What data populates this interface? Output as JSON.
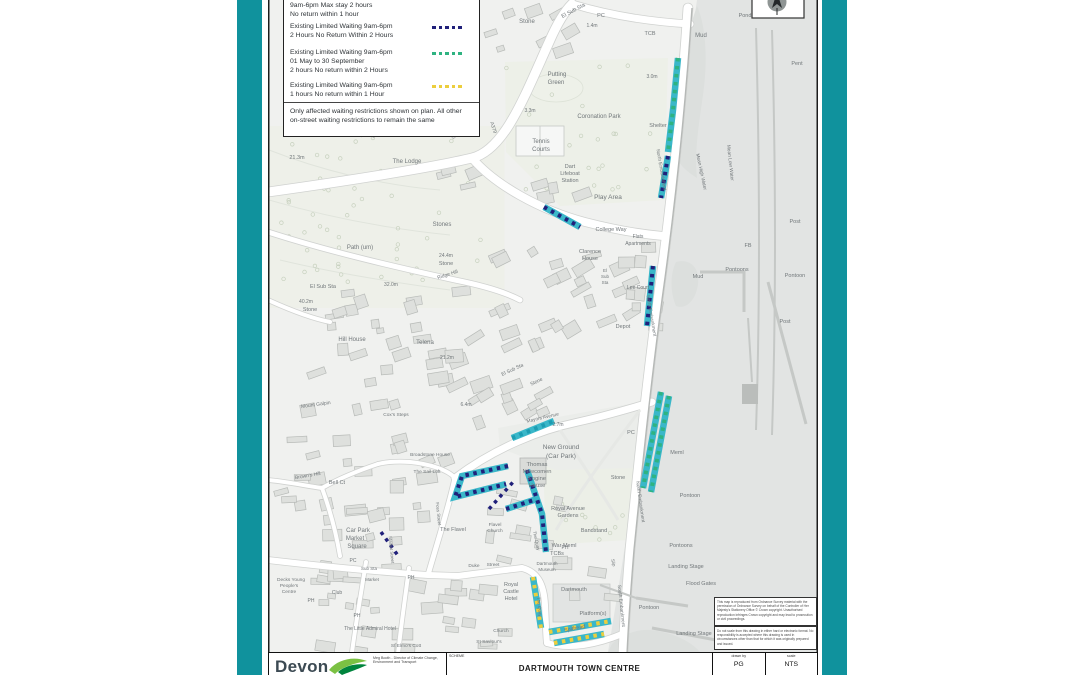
{
  "frame": {
    "teal": "#10929d",
    "sheet_border": "#1c1c1c"
  },
  "legend": {
    "entries": [
      {
        "lines": [
          "9am-6pm Max stay 2 hours",
          "No return within 1 hour"
        ],
        "swatch": null
      },
      {
        "lines": [
          "Existing Limited Waiting 9am-6pm",
          "2 Hours No Return Within 2 Hours"
        ],
        "swatch": "navy"
      },
      {
        "lines": [
          "Existing Limited Waiting 9am-6pm",
          "01 May to 30 September",
          "2 hours No return within 2 Hours"
        ],
        "swatch": "green"
      },
      {
        "lines": [
          "Existing Limited Waiting 9am-6pm",
          "1 hours No return within 1 Hour"
        ],
        "swatch": "yellow"
      }
    ],
    "note_lines": [
      "Only affected waiting restrictions shown on plan. All other",
      "on-street waiting restrictions to remain the same"
    ]
  },
  "title_block": {
    "logo_text": "Devon",
    "org_lines": [
      "Meg Booth - Director of Climate Change,",
      "Environment and Transport"
    ],
    "scheme_label": "SCHEME",
    "scheme": "DARTMOUTH TOWN CENTRE",
    "drawn_by_label": "drawn by",
    "drawn_by": "PG",
    "scale_label": "scale",
    "scale": "NTS"
  },
  "notes": {
    "copyright": "This map is reproduced from Ordnance Survey material with the permission of Ordnance Survey on behalf of the Controller of Her Majesty's Stationery Office © Crown copyright. Unauthorised reproduction infringes Crown copyright and may lead to prosecution or civil proceedings.",
    "disclaimer": "Do not scale from this drawing in either hard or electronic format. No responsibility is accepted where this drawing is used in circumstances other than that for which it was originally prepared and issued."
  },
  "map": {
    "colors": {
      "cyan": "#3ab7c9",
      "cyan-dark": "#1d9db2",
      "navy": "#20207a",
      "green": "#2fb381",
      "yellow": "#ecce3d"
    },
    "restrictions": [
      {
        "road": "North Embankment",
        "base": "cyan",
        "dash": "green",
        "pts": [
          [
            678,
            58
          ],
          [
            673,
            110
          ],
          [
            668,
            152
          ]
        ]
      },
      {
        "road": "North Embankment",
        "base": "cyan",
        "dash": "navy",
        "pts": [
          [
            668,
            156
          ],
          [
            661,
            198
          ]
        ]
      },
      {
        "road": "North Embankment",
        "base": "cyan",
        "dash": "navy",
        "pts": [
          [
            653,
            266
          ],
          [
            647,
            326
          ]
        ]
      },
      {
        "road": "North Embankment",
        "base": "cyan",
        "dash": "green",
        "pts": [
          [
            661,
            392
          ],
          [
            643,
            488
          ]
        ]
      },
      {
        "road": "North Embankment",
        "base": "cyan",
        "dash": "green",
        "pts": [
          [
            669,
            396
          ],
          [
            651,
            492
          ]
        ]
      },
      {
        "road": "College Way",
        "base": "cyan",
        "dash": "navy",
        "pts": [
          [
            544,
            207
          ],
          [
            580,
            227
          ]
        ]
      },
      {
        "road": "Mayors Avenue",
        "base": "cyan",
        "dash": "cyan-dark",
        "pts": [
          [
            512,
            438
          ],
          [
            554,
            421
          ]
        ]
      },
      {
        "road": "The Quay loop",
        "base": "cyan",
        "dash": "navy",
        "pts": [
          [
            508,
            466
          ],
          [
            462,
            476
          ],
          [
            455,
            497
          ],
          [
            506,
            484
          ]
        ]
      },
      {
        "road": "The Quay bar",
        "base": "cyan",
        "dash": "navy",
        "pts": [
          [
            506,
            509
          ],
          [
            534,
            500
          ]
        ]
      },
      {
        "road": "The Quay",
        "base": "cyan",
        "dash": "navy",
        "pts": [
          [
            527,
            470
          ],
          [
            542,
            514
          ],
          [
            546,
            552
          ]
        ]
      },
      {
        "road": "Mayors Avenue lower",
        "base": null,
        "dash": "navy",
        "pts": [
          [
            489,
            509
          ],
          [
            514,
            481
          ]
        ]
      },
      {
        "road": "Lower Street",
        "base": null,
        "dash": "navy",
        "pts": [
          [
            381,
            532
          ],
          [
            399,
            557
          ]
        ]
      },
      {
        "road": "The Quay south",
        "base": "cyan",
        "dash": "yellow",
        "pts": [
          [
            533,
            577
          ],
          [
            541,
            628
          ]
        ]
      },
      {
        "road": "Spithead",
        "base": "cyan",
        "dash": "yellow",
        "pts": [
          [
            549,
            632
          ],
          [
            611,
            621
          ]
        ]
      },
      {
        "road": "Spithead",
        "base": "cyan",
        "dash": "yellow",
        "pts": [
          [
            554,
            643
          ],
          [
            604,
            634
          ]
        ]
      }
    ],
    "labels": [
      {
        "t": "Stone",
        "x": 527,
        "y": 23
      },
      {
        "t": "El Sub Sta",
        "x": 574,
        "y": 12,
        "r": -28,
        "s": 5.5
      },
      {
        "t": "PC",
        "x": 601,
        "y": 17,
        "s": 5.5
      },
      {
        "t": "1.4m",
        "x": 592,
        "y": 27,
        "s": 5
      },
      {
        "t": "TCB",
        "x": 650,
        "y": 35,
        "s": 5.5
      },
      {
        "t": "Mud",
        "x": 701,
        "y": 37
      },
      {
        "t": "Pond",
        "x": 745,
        "y": 17,
        "s": 5.5
      },
      {
        "t": "Pent",
        "x": 797,
        "y": 65,
        "s": 5.5
      },
      {
        "t": "Putting",
        "x": 557,
        "y": 76
      },
      {
        "t": "Green",
        "x": 556,
        "y": 84
      },
      {
        "t": "3.0m",
        "x": 652,
        "y": 78,
        "s": 5
      },
      {
        "t": "3.3m",
        "x": 530,
        "y": 112,
        "s": 5
      },
      {
        "t": "Coronation Park",
        "x": 599,
        "y": 118
      },
      {
        "t": "Shelter",
        "x": 658,
        "y": 127,
        "s": 5.5
      },
      {
        "t": "Tennis",
        "x": 541,
        "y": 143
      },
      {
        "t": "Courts",
        "x": 541,
        "y": 151
      },
      {
        "t": "Dart",
        "x": 570,
        "y": 168,
        "s": 5.5
      },
      {
        "t": "Lifeboat",
        "x": 570,
        "y": 175,
        "s": 5.5
      },
      {
        "t": "Station",
        "x": 570,
        "y": 182,
        "s": 5.5
      },
      {
        "t": "Play Area",
        "x": 608,
        "y": 199,
        "s": 6.5
      },
      {
        "t": "21.3m",
        "x": 297,
        "y": 159,
        "s": 5.5
      },
      {
        "t": "The Lodge",
        "x": 407,
        "y": 163
      },
      {
        "t": "Stones",
        "x": 442,
        "y": 226
      },
      {
        "t": "Path (um)",
        "x": 360,
        "y": 249
      },
      {
        "t": "24.4m",
        "x": 446,
        "y": 257,
        "s": 5
      },
      {
        "t": "Stone",
        "x": 446,
        "y": 265,
        "s": 5.5
      },
      {
        "t": "Ridge Hill",
        "x": 448,
        "y": 276,
        "r": -18,
        "s": 5
      },
      {
        "t": "32.0m",
        "x": 391,
        "y": 286,
        "s": 5
      },
      {
        "t": "El Sub Sta",
        "x": 323,
        "y": 288,
        "s": 5.5
      },
      {
        "t": "40.2m",
        "x": 306,
        "y": 303,
        "s": 5
      },
      {
        "t": "Stone",
        "x": 310,
        "y": 311,
        "s": 5.5
      },
      {
        "t": "A379",
        "x": 492,
        "y": 128,
        "r": 72,
        "s": 5
      },
      {
        "t": "College Way",
        "x": 611,
        "y": 231,
        "s": 5.5
      },
      {
        "t": "Flats",
        "x": 638,
        "y": 238,
        "s": 5
      },
      {
        "t": "Apartments",
        "x": 638,
        "y": 245,
        "s": 5
      },
      {
        "t": "Clarence",
        "x": 590,
        "y": 253,
        "s": 5.5
      },
      {
        "t": "House",
        "x": 590,
        "y": 260,
        "s": 5.5
      },
      {
        "t": "El",
        "x": 605,
        "y": 272,
        "s": 4.5
      },
      {
        "t": "Sub",
        "x": 605,
        "y": 278,
        "s": 4.5
      },
      {
        "t": "Sta",
        "x": 605,
        "y": 284,
        "s": 4.5
      },
      {
        "t": "Lee Court",
        "x": 638,
        "y": 289,
        "s": 5
      },
      {
        "t": "North Embankment",
        "x": 660,
        "y": 170,
        "r": 80,
        "s": 4.8
      },
      {
        "t": "Mean High Water",
        "x": 700,
        "y": 172,
        "r": 78,
        "s": 4.8
      },
      {
        "t": "Mean Low Water",
        "x": 729,
        "y": 163,
        "r": 84,
        "s": 4.8
      },
      {
        "t": "Hill House",
        "x": 352,
        "y": 341
      },
      {
        "t": "Telena",
        "x": 425,
        "y": 344
      },
      {
        "t": "21.2m",
        "x": 447,
        "y": 359,
        "s": 5
      },
      {
        "t": "6.4m",
        "x": 466,
        "y": 406,
        "s": 5
      },
      {
        "t": "Depot",
        "x": 623,
        "y": 328,
        "s": 5.5
      },
      {
        "t": "North Embankment",
        "x": 650,
        "y": 316,
        "r": 80,
        "s": 4.8
      },
      {
        "t": "Mud",
        "x": 698,
        "y": 278,
        "s": 5.5
      },
      {
        "t": "Pontoons",
        "x": 737,
        "y": 271,
        "s": 5.5
      },
      {
        "t": "FB",
        "x": 748,
        "y": 247,
        "s": 5.5
      },
      {
        "t": "Post",
        "x": 795,
        "y": 223,
        "s": 5.5
      },
      {
        "t": "Pontoon",
        "x": 795,
        "y": 277,
        "s": 5.5
      },
      {
        "t": "Post",
        "x": 785,
        "y": 323,
        "s": 5.5
      },
      {
        "t": "El Sub Sta",
        "x": 513,
        "y": 371,
        "r": -25,
        "s": 5
      },
      {
        "t": "Stone",
        "x": 537,
        "y": 383,
        "r": -25,
        "s": 5
      },
      {
        "t": "Mount Galpin",
        "x": 316,
        "y": 406,
        "r": -8,
        "s": 5
      },
      {
        "t": "Cox's Steps",
        "x": 396,
        "y": 416,
        "s": 4.8
      },
      {
        "t": "Brown's Hill",
        "x": 308,
        "y": 477,
        "r": -10,
        "s": 5
      },
      {
        "t": "Bell Ct",
        "x": 337,
        "y": 484,
        "s": 5.5
      },
      {
        "t": "Mayors Avenue",
        "x": 543,
        "y": 419,
        "r": -13,
        "s": 4.8
      },
      {
        "t": "2.7m",
        "x": 558,
        "y": 426,
        "s": 5
      },
      {
        "t": "New Ground",
        "x": 561,
        "y": 449,
        "s": 6.5
      },
      {
        "t": "(Car Park)",
        "x": 561,
        "y": 458,
        "s": 6.5
      },
      {
        "t": "Thomas",
        "x": 537,
        "y": 466,
        "s": 5.8
      },
      {
        "t": "Newcomen",
        "x": 537,
        "y": 473,
        "s": 5.8
      },
      {
        "t": "Engine",
        "x": 537,
        "y": 480,
        "s": 5.8
      },
      {
        "t": "House",
        "x": 537,
        "y": 487,
        "s": 5.8
      },
      {
        "t": "PC",
        "x": 631,
        "y": 434,
        "s": 5.5
      },
      {
        "t": "Meml",
        "x": 677,
        "y": 454,
        "s": 5.5
      },
      {
        "t": "Stone",
        "x": 618,
        "y": 479,
        "s": 5.5
      },
      {
        "t": "North Embankment",
        "x": 639,
        "y": 502,
        "r": 82,
        "s": 4.8
      },
      {
        "t": "Pontoon",
        "x": 690,
        "y": 497,
        "s": 5.5
      },
      {
        "t": "Royal Avenue",
        "x": 568,
        "y": 510,
        "s": 5.5
      },
      {
        "t": "Gardens",
        "x": 568,
        "y": 517,
        "s": 5.5
      },
      {
        "t": "Bandstand",
        "x": 594,
        "y": 532,
        "s": 5.5
      },
      {
        "t": "War Meml",
        "x": 564,
        "y": 547,
        "s": 5.5
      },
      {
        "t": "Pontoons",
        "x": 681,
        "y": 547,
        "s": 5.5
      },
      {
        "t": "Landing Stage",
        "x": 686,
        "y": 568,
        "s": 5.5
      },
      {
        "t": "Flood Gates",
        "x": 701,
        "y": 585,
        "s": 5.5
      },
      {
        "t": "Pontoon",
        "x": 649,
        "y": 609,
        "s": 5.5
      },
      {
        "t": "Landing Stage",
        "x": 694,
        "y": 635,
        "s": 5.5
      },
      {
        "t": "South Embankment",
        "x": 620,
        "y": 606,
        "r": 84,
        "s": 4.8
      },
      {
        "t": "Slip",
        "x": 612,
        "y": 563,
        "r": 76,
        "s": 4.5
      },
      {
        "t": "TCBs",
        "x": 557,
        "y": 555,
        "s": 5.5
      },
      {
        "t": "PH",
        "x": 565,
        "y": 549,
        "s": 5
      },
      {
        "t": "Dartmouth",
        "x": 574,
        "y": 591,
        "s": 5.5
      },
      {
        "t": "Platform(s)",
        "x": 593,
        "y": 615,
        "s": 5.5
      },
      {
        "t": "Spithead",
        "x": 575,
        "y": 630,
        "r": -11,
        "s": 5.5
      },
      {
        "t": "Broadstone House",
        "x": 430,
        "y": 456,
        "s": 4.8
      },
      {
        "t": "The Sail Loft",
        "x": 427,
        "y": 473,
        "s": 4.8
      },
      {
        "t": "Foss Street",
        "x": 437,
        "y": 514,
        "r": 84,
        "s": 4.5
      },
      {
        "t": "The Flavel",
        "x": 453,
        "y": 531,
        "s": 5.5
      },
      {
        "t": "Flavel",
        "x": 495,
        "y": 526,
        "s": 4.8
      },
      {
        "t": "Church",
        "x": 495,
        "y": 532,
        "s": 4.8
      },
      {
        "t": "The Quay",
        "x": 535,
        "y": 541,
        "r": 78,
        "s": 4.5
      },
      {
        "t": "Market Street",
        "x": 390,
        "y": 550,
        "r": 84,
        "s": 4.5
      },
      {
        "t": "Car Park",
        "x": 358,
        "y": 532
      },
      {
        "t": "Market",
        "x": 355,
        "y": 540
      },
      {
        "t": "Square",
        "x": 357,
        "y": 548
      },
      {
        "t": "Duke",
        "x": 474,
        "y": 567,
        "s": 4.8
      },
      {
        "t": "Street",
        "x": 493,
        "y": 566,
        "s": 4.8
      },
      {
        "t": "Dartmouth",
        "x": 547,
        "y": 565,
        "s": 4.5
      },
      {
        "t": "Museum",
        "x": 547,
        "y": 571,
        "s": 4.5
      },
      {
        "t": "Royal",
        "x": 511,
        "y": 586,
        "s": 5.5
      },
      {
        "t": "Castle",
        "x": 511,
        "y": 593,
        "s": 5.5
      },
      {
        "t": "Hotel",
        "x": 511,
        "y": 600,
        "s": 5.5
      },
      {
        "t": "The Quay",
        "x": 538,
        "y": 607,
        "r": 84,
        "s": 4.5
      },
      {
        "t": "Church",
        "x": 501,
        "y": 632,
        "s": 4.8
      },
      {
        "t": "St Saviour's",
        "x": 489,
        "y": 643,
        "s": 4.8
      },
      {
        "t": "Decks Young",
        "x": 291,
        "y": 581,
        "s": 4.8
      },
      {
        "t": "People's",
        "x": 289,
        "y": 587,
        "s": 4.8
      },
      {
        "t": "Centre",
        "x": 289,
        "y": 593,
        "s": 4.8
      },
      {
        "t": "PH",
        "x": 311,
        "y": 602,
        "s": 5
      },
      {
        "t": "Club",
        "x": 337,
        "y": 594,
        "s": 5
      },
      {
        "t": "PC",
        "x": 353,
        "y": 562,
        "s": 5
      },
      {
        "t": "Sub Sta",
        "x": 369,
        "y": 570,
        "s": 4.5
      },
      {
        "t": "Market",
        "x": 372,
        "y": 581,
        "s": 4.5
      },
      {
        "t": "PH",
        "x": 357,
        "y": 617,
        "s": 5
      },
      {
        "t": "PH",
        "x": 411,
        "y": 579,
        "s": 5
      },
      {
        "t": "The Little Admiral Hotel",
        "x": 370,
        "y": 630,
        "s": 5
      },
      {
        "t": "St Elmo's Cott",
        "x": 406,
        "y": 647,
        "s": 4.8
      }
    ]
  }
}
